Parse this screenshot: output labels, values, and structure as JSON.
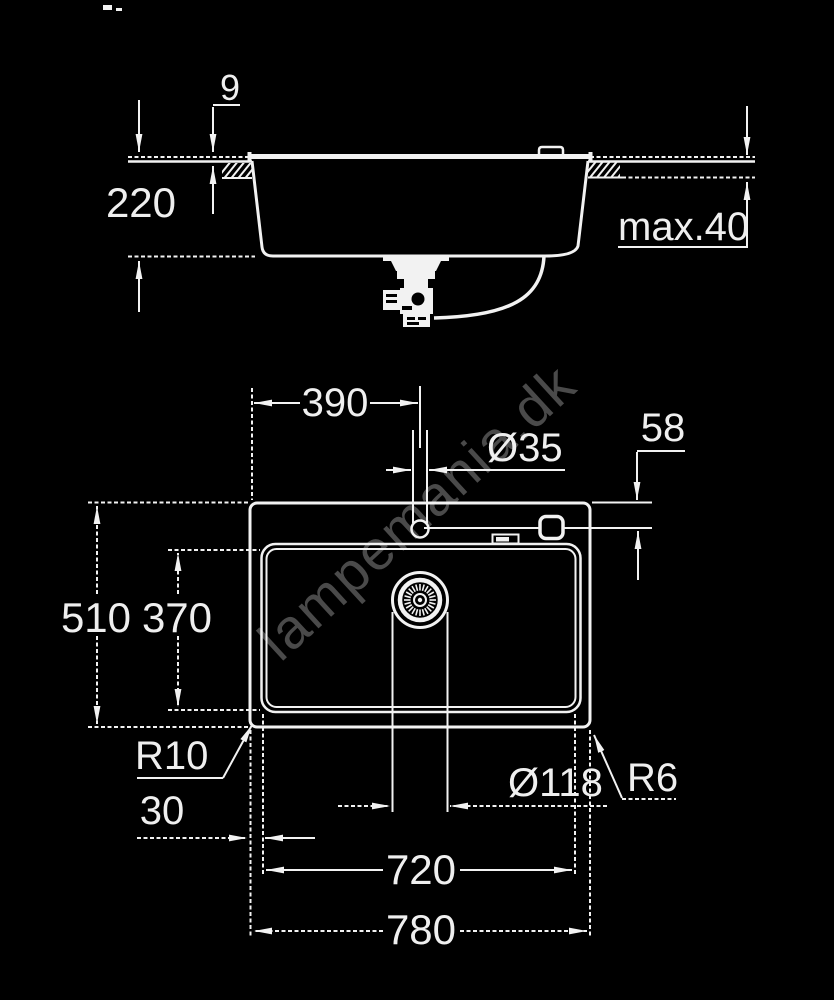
{
  "watermark": "lampemania.dk",
  "colors": {
    "background": "#000000",
    "line": "#f2f2f2",
    "watermark": "#4a4a4a"
  },
  "side_view": {
    "labels": {
      "rim_height": "9",
      "depth": "220",
      "counter_thickness": "max.40"
    }
  },
  "plan_view": {
    "labels": {
      "faucet_offset": "390",
      "faucet_hole": "Ø35",
      "faucet_from_edge": "58",
      "overall_depth": "510",
      "bowl_depth": "370",
      "bowl_corner_radius": "R10",
      "edge_to_bowl": "30",
      "drain_diameter": "Ø118",
      "outer_corner_radius": "R6",
      "bowl_width": "720",
      "overall_width": "780"
    }
  }
}
